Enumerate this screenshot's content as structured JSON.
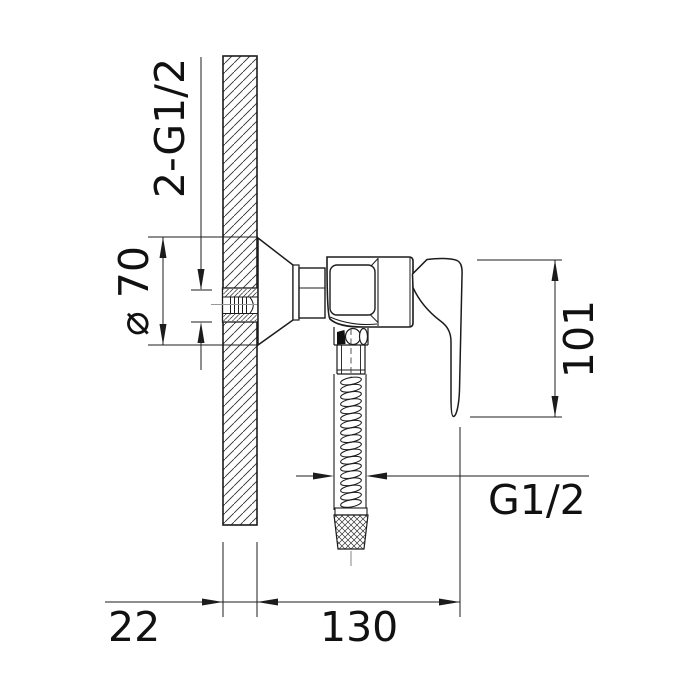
{
  "drawing": {
    "type": "technical-drawing",
    "subject": "wall-mounted shower mixer, side section view",
    "dims": {
      "wall_thread": "2-G1/2",
      "flange_diameter": "⌀ 70",
      "height": "101",
      "hose_thread": "G1/2",
      "wall_thickness": "22",
      "depth": "130"
    },
    "colors": {
      "line": "#1c1c1c",
      "centerline": "#999999",
      "background": "#ffffff"
    }
  }
}
